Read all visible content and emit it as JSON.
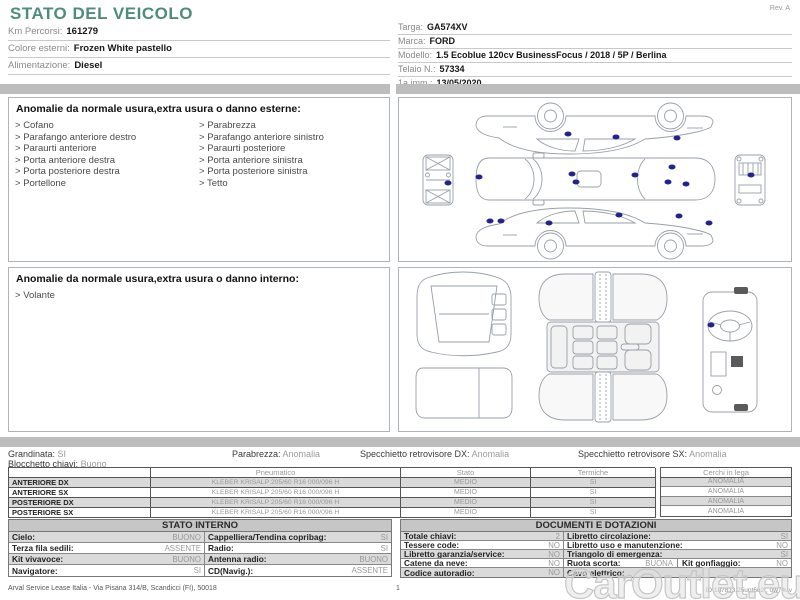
{
  "header": {
    "title": "STATO DEL VEICOLO",
    "rev": "Rev. A",
    "left_fields": [
      {
        "label": "Km Percorsi:",
        "value": "161279"
      },
      {
        "label": "Colore esterni:",
        "value": "Frozen White pastello"
      },
      {
        "label": "Alimentazione:",
        "value": "Diesel"
      }
    ],
    "right_fields": [
      {
        "label": "Targa:",
        "value": "GA574XV"
      },
      {
        "label": "Marca:",
        "value": "FORD"
      },
      {
        "label": "Modello:",
        "value": "1.5 Ecoblue 120cv BusinessFocus / 2018 / 5P / Berlina"
      },
      {
        "label": "Telaio N.:",
        "value": "57334"
      },
      {
        "label": "1a imm.:",
        "value": "13/05/2020"
      }
    ]
  },
  "exterior_anomalies": {
    "title": "Anomalie da normale usura,extra usura o danno esterne:",
    "col1": [
      "Cofano",
      "Parafango anteriore destro",
      "Paraurti anteriore",
      "Porta anteriore destra",
      "Porta posteriore destra",
      "Portellone"
    ],
    "col2": [
      "Parabrezza",
      "Parafango anteriore sinistro",
      "Paraurti posteriore",
      "Porta anteriore sinistra",
      "Porta posteriore sinistra",
      "Tetto"
    ]
  },
  "interior_anomalies": {
    "title": "Anomalie da normale usura,extra usura o danno interno:",
    "items": [
      "Volante"
    ]
  },
  "diagrams": {
    "exterior_dots": [
      [
        43.1,
        21.8
      ],
      [
        55.4,
        24.2
      ],
      [
        71.0,
        24.8
      ],
      [
        44.1,
        46.7
      ],
      [
        45.1,
        51.5
      ],
      [
        60.3,
        47.3
      ],
      [
        69.7,
        42.4
      ],
      [
        68.5,
        51.5
      ],
      [
        73.3,
        52.7
      ],
      [
        12.6,
        52.1
      ],
      [
        20.3,
        48.5
      ],
      [
        89.7,
        47.3
      ],
      [
        23.3,
        75.2
      ],
      [
        26.0,
        75.2
      ],
      [
        38.2,
        76.4
      ],
      [
        56.2,
        71.5
      ],
      [
        71.5,
        72.1
      ],
      [
        79.2,
        76.4
      ]
    ],
    "interior_dots": [
      [
        79.7,
        35.2
      ]
    ]
  },
  "summary": {
    "grandinata": {
      "label": "Grandinata:",
      "value": "SI"
    },
    "parabrezza": {
      "label": "Parabrezza:",
      "value": "Anomalia"
    },
    "specchietto_dx": {
      "label": "Specchietto retrovisore DX:",
      "value": "Anomalia"
    },
    "specchietto_sx": {
      "label": "Specchietto retrovisore SX:",
      "value": "Anomalia"
    },
    "blocchetto": {
      "label": "Blocchetto chiavi:",
      "value": "Buono"
    }
  },
  "tyres": {
    "headers": {
      "pneumatico": "Pneumatico",
      "stato": "Stato",
      "termiche": "Termiche",
      "cerchi": "Cerchi in lega"
    },
    "rows": [
      {
        "pos": "ANTERIORE DX",
        "tyre": "KLEBER KRISALP 205/60 R16 000/096 H",
        "stato": "MEDIO",
        "termiche": "SI",
        "cerchi": "ANOMALIA"
      },
      {
        "pos": "ANTERIORE SX",
        "tyre": "KLEBER KRISALP 205/60 R16 000/096 H",
        "stato": "MEDIO",
        "termiche": "SI",
        "cerchi": "ANOMALIA"
      },
      {
        "pos": "POSTERIORE DX",
        "tyre": "KLEBER KRISALP 205/60 R16 000/096 H",
        "stato": "MEDIO",
        "termiche": "SI",
        "cerchi": "ANOMALIA"
      },
      {
        "pos": "POSTERIORE SX",
        "tyre": "KLEBER KRISALP 205/60 R16 000/096 H",
        "stato": "MEDIO",
        "termiche": "SI",
        "cerchi": "ANOMALIA"
      }
    ]
  },
  "stato_interno": {
    "title": "STATO INTERNO",
    "rows": [
      {
        "pairs": [
          {
            "label": "Cielo:",
            "value": "BUONO"
          },
          {
            "label": "Cappelliera/Tendina copribag:",
            "value": "SI"
          }
        ]
      },
      {
        "pairs": [
          {
            "label": "Terza fila sedili:",
            "value": "ASSENTE"
          },
          {
            "label": "Radio:",
            "value": "SI"
          }
        ]
      },
      {
        "pairs": [
          {
            "label": "Kit vivavoce:",
            "value": "BUONO"
          },
          {
            "label": "Antenna radio:",
            "value": "BUONO"
          }
        ]
      },
      {
        "pairs": [
          {
            "label": "Navigatore:",
            "value": "SI"
          },
          {
            "label": "CD(Navig.):",
            "value": "ASSENTE"
          }
        ]
      }
    ]
  },
  "documenti": {
    "title": "DOCUMENTI E DOTAZIONI",
    "rows": [
      {
        "pairs": [
          {
            "label": "Totale chiavi:",
            "value": "2"
          },
          {
            "label": "Libretto circolazione:",
            "value": "SI"
          }
        ]
      },
      {
        "pairs": [
          {
            "label": "Tessere code:",
            "value": "NO"
          },
          {
            "label": "Libretto uso e manutenzione:",
            "value": "NO"
          }
        ]
      },
      {
        "pairs": [
          {
            "label": "Libretto garanzia/service:",
            "value": "NO"
          },
          {
            "label": "Triangolo di emergenza:",
            "value": "SI"
          }
        ]
      },
      {
        "pairs": [
          {
            "label": "Catene da neve:",
            "value": "NO"
          },
          {
            "label": "Ruota scorta:",
            "value": "BUONA"
          },
          {
            "label": "Kit gonfiaggio:",
            "value": "NO"
          }
        ]
      },
      {
        "pairs": [
          {
            "label": "Codice autoradio:",
            "value": "NO"
          },
          {
            "label": "Cavo elettrico:",
            "value": ""
          }
        ]
      }
    ]
  },
  "footer": {
    "company": "Arval Service Lease Italia - Via Pisana 314/B, Scandicci (FI), 50018",
    "page": "1",
    "doc_id": "ID 1u78J3.25upt6u2 , 0w74uv"
  },
  "watermark": {
    "text": "CarOutlet.eu"
  },
  "colors": {
    "accent": "#4e8c7b",
    "damage_dot": "#23238f",
    "band": "#bdbdbd",
    "row_shade": "#dadada"
  }
}
